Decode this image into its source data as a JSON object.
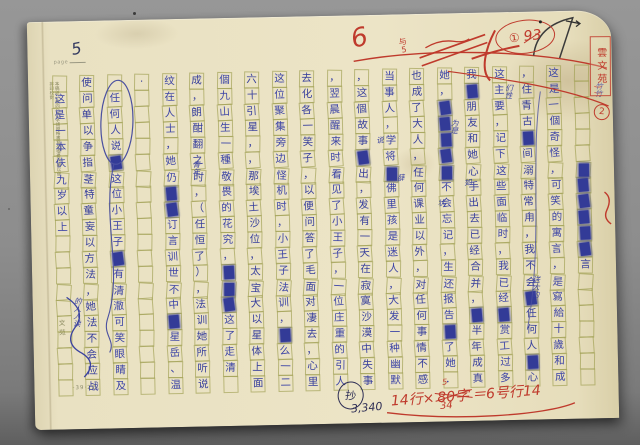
{
  "page": {
    "label": "page",
    "number": "5",
    "footer_code": "-39·22-",
    "margin_note": "本稿紙一張四〇〇字請照格書寫勿摺疊污損以便排印校對",
    "brand": "文苑",
    "char_count": "3,340",
    "proof_mark": "抄"
  },
  "grid": {
    "rows": 20,
    "columns": 20,
    "reading": "vertical text, columns read right-to-left; ■ = inked-out deletion, □ = empty cell",
    "cells": [
      "□□□□□□■■■■■■言□□□□□□□",
      "这是一個奇怪，可笑的寓言，是寫給十歲和成",
      "，住青古■间溺特常甪，我不会■任何人■心",
      "这主要，记下这些面临时，我已经■赏工过多",
      "我■朋友和她心手出去已经合并，■半年成真",
      "她，■■■■■不会忘记，生还报告■了她．",
      "也成了大人，任何课业以外，对任何事情不感",
      "当事人，学将■佛里孩是迷人，大发一种幽默",
      "，这個故事■出，发有一天在寂寞沙漠中失事",
      "，翌晨醒来时看见了小王子，一位庄重的引人",
      "去化各一笑子，以便问答了毛面对凄去，心里",
      "这位聚集旁边怪机时，小王子法训，■么一二",
      "六十引星，，那埃土沙位，太宝大以星体上面",
      "個九山生一種敬畏的花究，■■■这了走清□",
      "成，朗酣翻之时，（任恒了），法训她所听说",
      "纹在人士，她仍■■订言训世不中■星岳、温",
      "·□□□□□□□□□□□□□□□□□□□",
      "□任何人说■这位小王子■有清澈可笑眼睛及",
      "使问单以争指茎特童妄以方法，她法不会应战",
      "□这是一本伕九岁以上□□□□□□□□□□"
    ]
  },
  "inserts": [
    {
      "text": "说",
      "x": 347,
      "y": 122,
      "vertical": false
    },
    {
      "text": "薛",
      "x": 367,
      "y": 160,
      "vertical": false
    },
    {
      "text": "青年",
      "x": 162,
      "y": 142,
      "vertical": true
    },
    {
      "text": "为是",
      "x": 421,
      "y": 106,
      "vertical": true
    },
    {
      "text": "如",
      "x": 434,
      "y": 166,
      "vertical": false
    },
    {
      "text": "状",
      "x": 407,
      "y": 186,
      "vertical": false
    },
    {
      "text": "送大约",
      "x": 499,
      "y": 264,
      "vertical": true
    },
    {
      "text": "竹竹",
      "x": 566,
      "y": 72,
      "vertical": true
    },
    {
      "text": "们性",
      "x": 476,
      "y": 72,
      "vertical": true
    },
    {
      "text": "的人人读",
      "x": 40,
      "y": 276,
      "vertical": true
    }
  ],
  "red": {
    "mark_6": "6",
    "fraction_top": "与",
    "fraction_bottom": "5",
    "circled_one": "①",
    "score": "93",
    "stamp": "雲文苑",
    "circled_two": "2",
    "formula_prefix": "14行×",
    "formula_struck": "80字",
    "formula_above": "5",
    "formula_below": "34",
    "formula_result": "＝6号行14"
  },
  "colors": {
    "background_gray": "#8d8d8d",
    "paper": "#e9e1c2",
    "grid_line": "#9e9e50",
    "ink_blue": "#38409c",
    "ink_red": "#bf3a2c",
    "ink_black": "#3a3a3a"
  }
}
